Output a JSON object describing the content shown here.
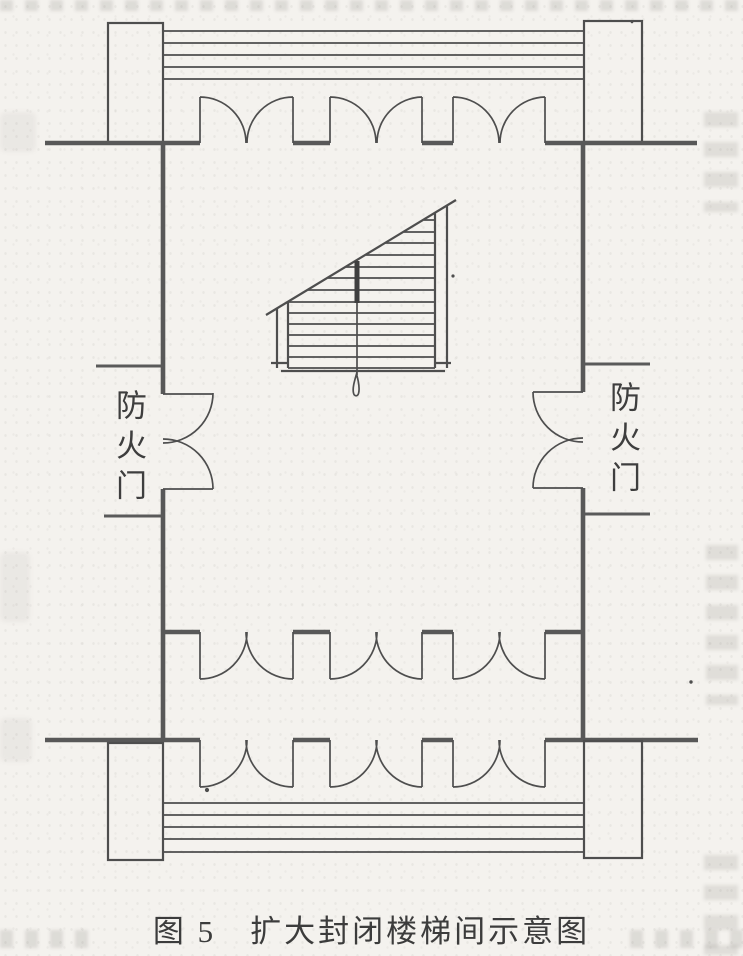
{
  "figure": {
    "caption": "图 5　扩大封闭楼梯间示意图",
    "fire_door_label_left": "防火门",
    "fire_door_label_right": "防火门"
  },
  "colors": {
    "paper_background": "#f4f2ee",
    "drawing_line": "#4e4e4e",
    "text": "#3c3c3c"
  }
}
